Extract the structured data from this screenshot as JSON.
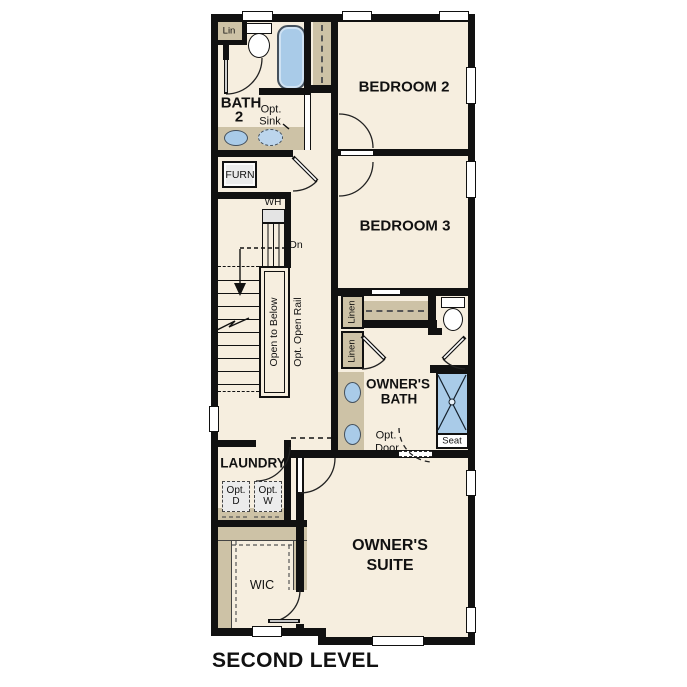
{
  "title": "SECOND LEVEL",
  "colors": {
    "floor": "#f6eedf",
    "cabinet_tan": "#cdc2a6",
    "fixture_blue": "#a9cbe8",
    "wall_black": "#111111",
    "appliance_gray": "#ebebeb"
  },
  "rooms": {
    "bedroom2": "BEDROOM 2",
    "bedroom3": "BEDROOM 3",
    "bath2": {
      "line1": "BATH",
      "line2": "2"
    },
    "owners_bath": {
      "line1": "OWNER'S",
      "line2": "BATH"
    },
    "owners_suite": {
      "line1": "OWNER'S",
      "line2": "SUITE"
    },
    "laundry": "LAUNDRY",
    "wic": "WIC"
  },
  "features": {
    "lin_closet": "Lin",
    "opt_sink": {
      "line1": "Opt.",
      "line2": "Sink"
    },
    "furnace": "FURN",
    "water_heater": "WH",
    "stairs_down": "Dn",
    "open_to_below": "Open to Below",
    "opt_open_rail": "Opt. Open Rail",
    "linen_upper": "Linen",
    "linen_lower": "Linen",
    "opt_door": {
      "line1": "Opt.",
      "line2": "Door"
    },
    "shower_seat": "Seat",
    "opt_dryer": {
      "line1": "Opt.",
      "line2": "D"
    },
    "opt_washer": {
      "line1": "Opt.",
      "line2": "W"
    }
  }
}
